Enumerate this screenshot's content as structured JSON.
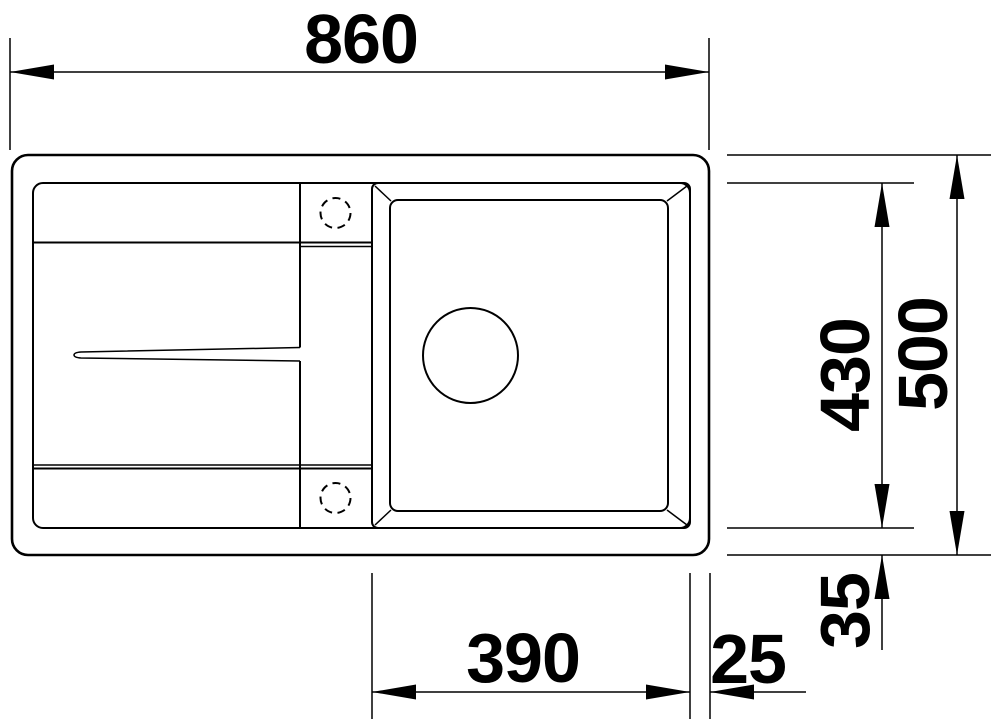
{
  "drawing": {
    "type": "technical-dimension-drawing",
    "subject": "sink plan view with drainboard and bowl",
    "background_color": "#ffffff",
    "line_color": "#000000",
    "labels": {
      "width_total": "860",
      "depth_total": "500",
      "depth_bowl": "430",
      "offset_bowl_bottom": "35",
      "width_bowl": "390",
      "offset_bowl_right": "25"
    }
  }
}
